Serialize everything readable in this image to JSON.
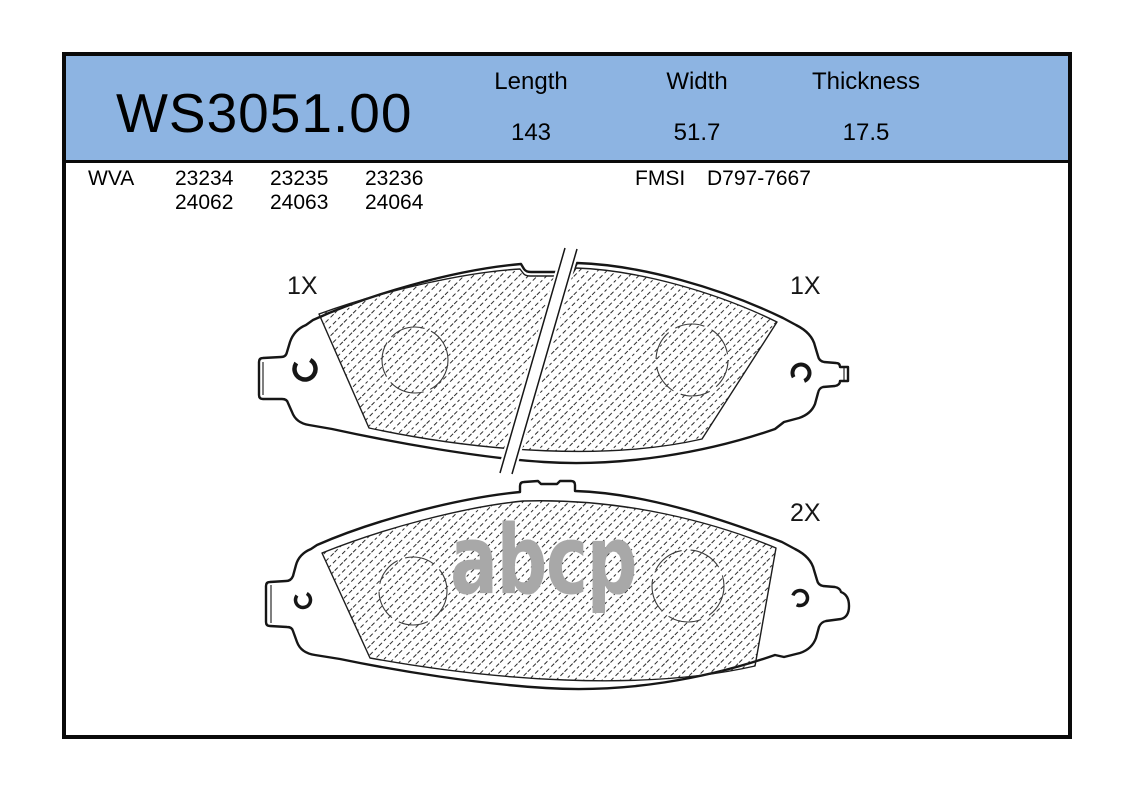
{
  "part": {
    "number": "WS3051.00"
  },
  "specs": {
    "columns": [
      {
        "label": "Length",
        "value": "143"
      },
      {
        "label": "Width",
        "value": "51.7"
      },
      {
        "label": "Thickness",
        "value": "17.5"
      }
    ]
  },
  "cross_refs": {
    "wva_label": "WVA",
    "wva_numbers": [
      [
        "23234",
        "23235",
        "23236"
      ],
      [
        "24062",
        "24063",
        "24064"
      ]
    ],
    "fmsi_label": "FMSI",
    "fmsi_value": "D797-7667"
  },
  "drawing": {
    "qty_top_left": "1X",
    "qty_top_right": "1X",
    "qty_bottom_right": "2X",
    "watermark": "abcp"
  },
  "colors": {
    "header_bg": "#8DB4E2",
    "border": "#0a0a0a",
    "line": "#161616",
    "watermark": "#a8a8a8"
  }
}
